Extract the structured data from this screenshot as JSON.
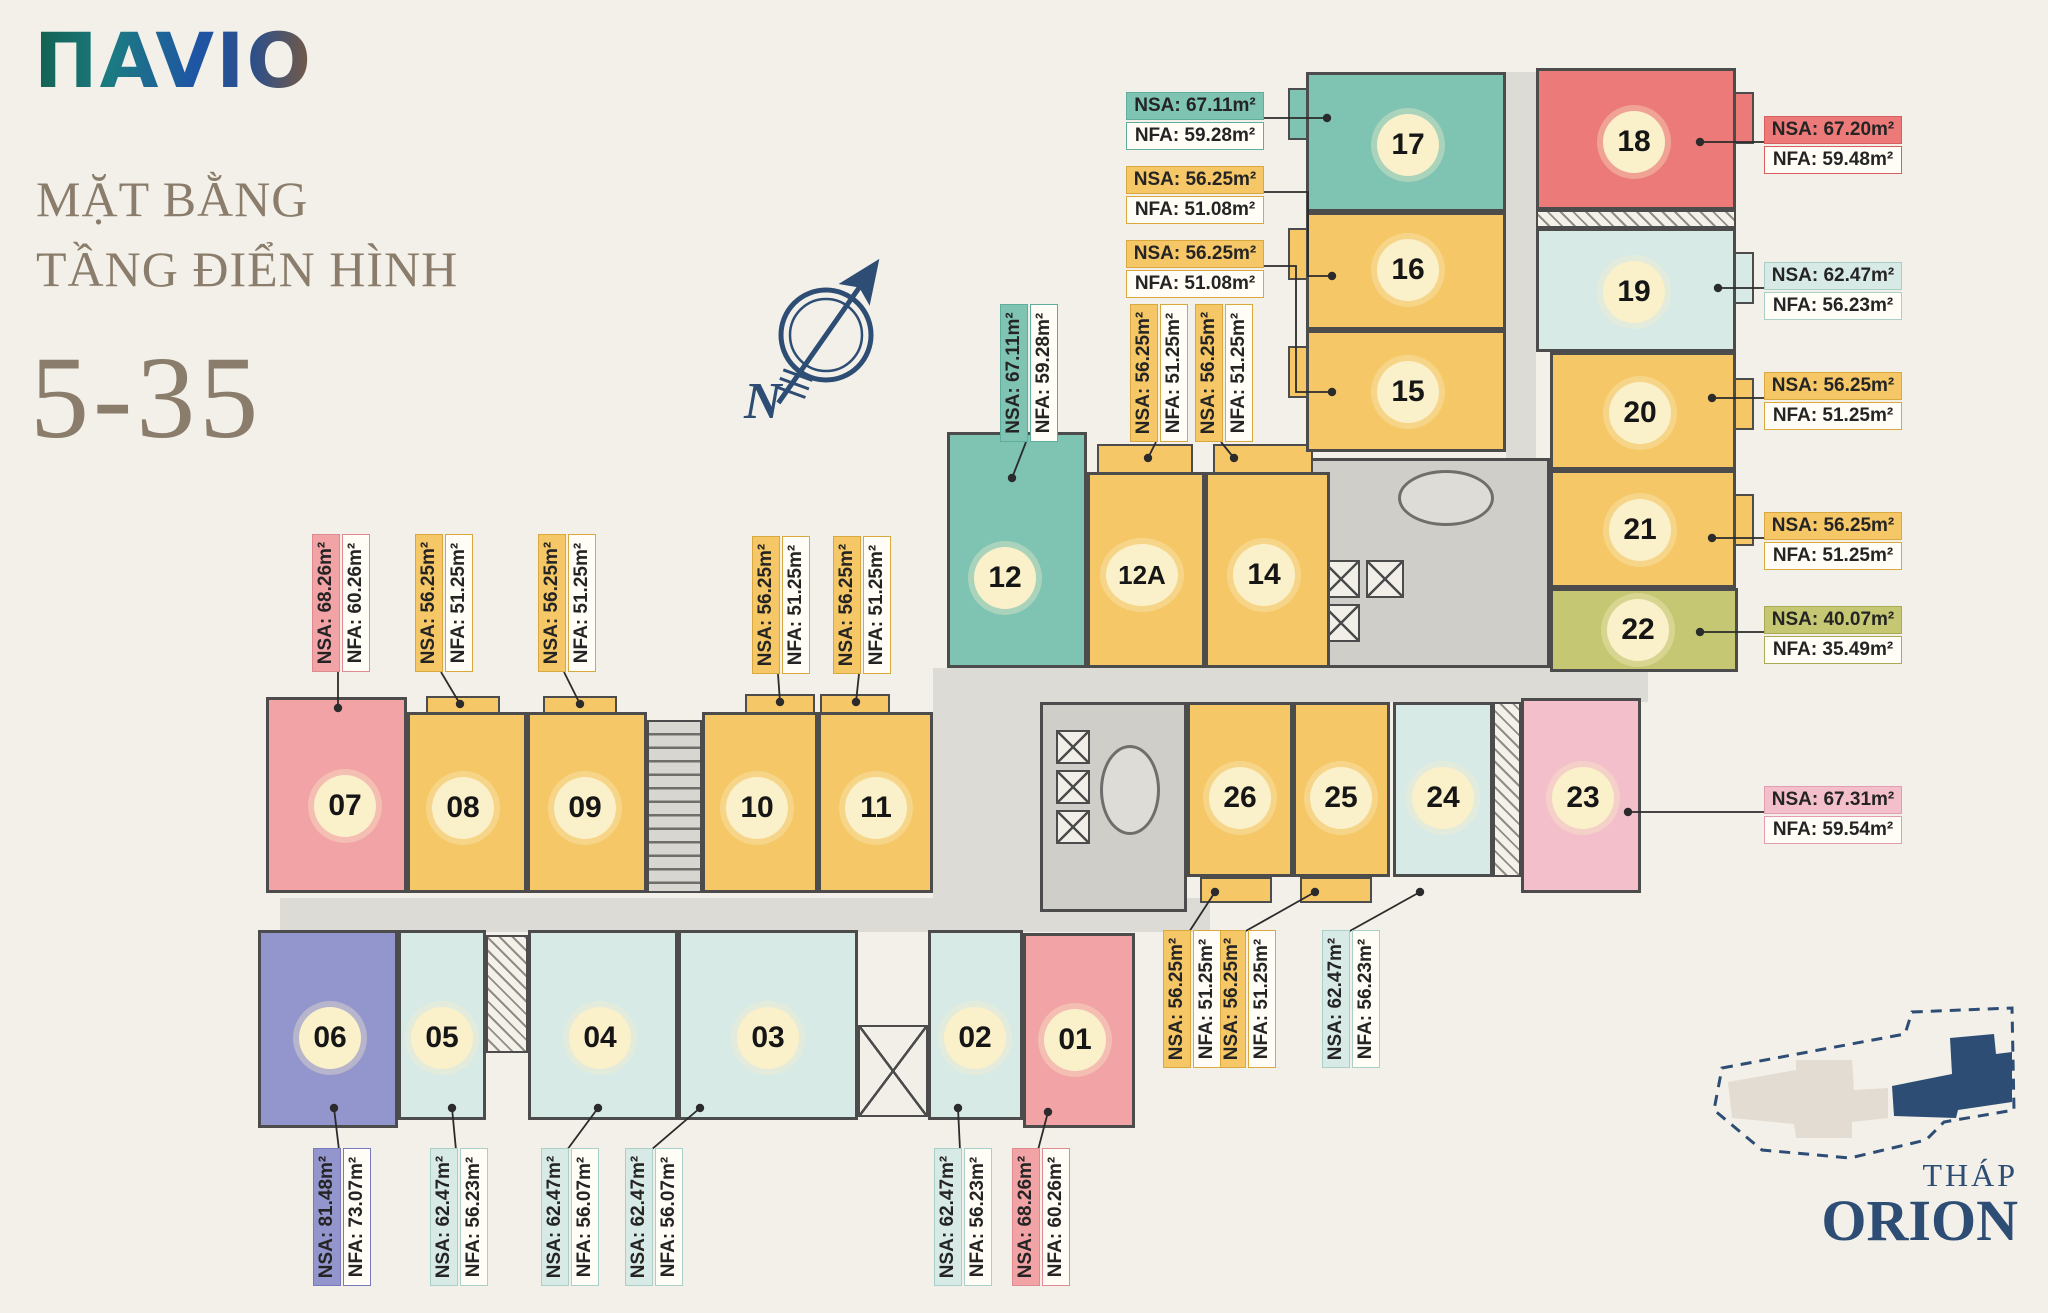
{
  "branding": {
    "logo_text": "ΠAVIO"
  },
  "title": {
    "line1": "MẶT BẰNG",
    "line2": "TẦNG ĐIỂN HÌNH",
    "floor_range": "5-35"
  },
  "compass": {
    "north_label": "N"
  },
  "key_plan": {
    "label_line1": "THÁP",
    "label_line2": "ORION"
  },
  "palette": {
    "background": "#f3f0e9",
    "wall": "#4c4c4c",
    "corridor": "#dcdbd5",
    "badge_fill": "#faf0c9",
    "navy": "#2d4d74",
    "title_color": "#8b7d6b",
    "leader": "#2b2b2b",
    "teal": {
      "fill": "#7fc3b3",
      "border": "#5fae9d"
    },
    "yellow": {
      "fill": "#f6c766",
      "border": "#d9a93f"
    },
    "red": {
      "fill": "#ec7a78",
      "border": "#d95f5f"
    },
    "salmon": {
      "fill": "#f2a3a6",
      "border": "#df8a90"
    },
    "cyan": {
      "fill": "#d8eae6",
      "border": "#a8cfc8"
    },
    "purple": {
      "fill": "#9395cd",
      "border": "#777bbd"
    },
    "olive": {
      "fill": "#c6c773",
      "border": "#a9aa52"
    },
    "pink": {
      "fill": "#f3bfca",
      "border": "#e39cb0"
    }
  },
  "units": [
    {
      "no": "01",
      "color": "salmon",
      "nsa": "NSA: 68.26m²",
      "nfa": "NFA: 60.26m²"
    },
    {
      "no": "02",
      "color": "cyan",
      "nsa": "NSA: 62.47m²",
      "nfa": "NFA: 56.23m²"
    },
    {
      "no": "03",
      "color": "cyan",
      "nsa": "NSA: 62.47m²",
      "nfa": "NFA: 56.07m²"
    },
    {
      "no": "04",
      "color": "cyan",
      "nsa": "NSA: 62.47m²",
      "nfa": "NFA: 56.07m²"
    },
    {
      "no": "05",
      "color": "cyan",
      "nsa": "NSA: 62.47m²",
      "nfa": "NFA: 56.23m²"
    },
    {
      "no": "06",
      "color": "purple",
      "nsa": "NSA: 81.48m²",
      "nfa": "NFA: 73.07m²"
    },
    {
      "no": "07",
      "color": "salmon",
      "nsa": "NSA: 68.26m²",
      "nfa": "NFA: 60.26m²"
    },
    {
      "no": "08",
      "color": "yellow",
      "nsa": "NSA: 56.25m²",
      "nfa": "NFA: 51.25m²"
    },
    {
      "no": "09",
      "color": "yellow",
      "nsa": "NSA: 56.25m²",
      "nfa": "NFA: 51.25m²"
    },
    {
      "no": "10",
      "color": "yellow",
      "nsa": "NSA: 56.25m²",
      "nfa": "NFA: 51.25m²"
    },
    {
      "no": "11",
      "color": "yellow",
      "nsa": "NSA: 56.25m²",
      "nfa": "NFA: 51.25m²"
    },
    {
      "no": "12",
      "color": "teal",
      "nsa": "NSA: 67.11m²",
      "nfa": "NFA: 59.28m²"
    },
    {
      "no": "12A",
      "color": "yellow",
      "nsa": "NSA: 56.25m²",
      "nfa": "NFA: 51.25m²"
    },
    {
      "no": "14",
      "color": "yellow",
      "nsa": "NSA: 56.25m²",
      "nfa": "NFA: 51.25m²"
    },
    {
      "no": "15",
      "color": "yellow",
      "nsa": "NSA: 56.25m²",
      "nfa": "NFA: 51.08m²"
    },
    {
      "no": "16",
      "color": "yellow",
      "nsa": "NSA: 56.25m²",
      "nfa": "NFA: 51.08m²"
    },
    {
      "no": "17",
      "color": "teal",
      "nsa": "NSA: 67.11m²",
      "nfa": "NFA: 59.28m²"
    },
    {
      "no": "18",
      "color": "red",
      "nsa": "NSA: 67.20m²",
      "nfa": "NFA: 59.48m²"
    },
    {
      "no": "19",
      "color": "cyan",
      "nsa": "NSA: 62.47m²",
      "nfa": "NFA: 56.23m²"
    },
    {
      "no": "20",
      "color": "yellow",
      "nsa": "NSA: 56.25m²",
      "nfa": "NFA: 51.25m²"
    },
    {
      "no": "21",
      "color": "yellow",
      "nsa": "NSA: 56.25m²",
      "nfa": "NFA: 51.25m²"
    },
    {
      "no": "22",
      "color": "olive",
      "nsa": "NSA: 40.07m²",
      "nfa": "NFA: 35.49m²"
    },
    {
      "no": "23",
      "color": "pink",
      "nsa": "NSA: 67.31m²",
      "nfa": "NFA: 59.54m²"
    },
    {
      "no": "24",
      "color": "cyan",
      "nsa": "NSA: 62.47m²",
      "nfa": "NFA: 56.23m²"
    },
    {
      "no": "25",
      "color": "yellow",
      "nsa": "NSA: 56.25m²",
      "nfa": "NFA: 51.25m²"
    },
    {
      "no": "26",
      "color": "yellow",
      "nsa": "NSA: 56.25m²",
      "nfa": "NFA: 51.25m²"
    }
  ]
}
